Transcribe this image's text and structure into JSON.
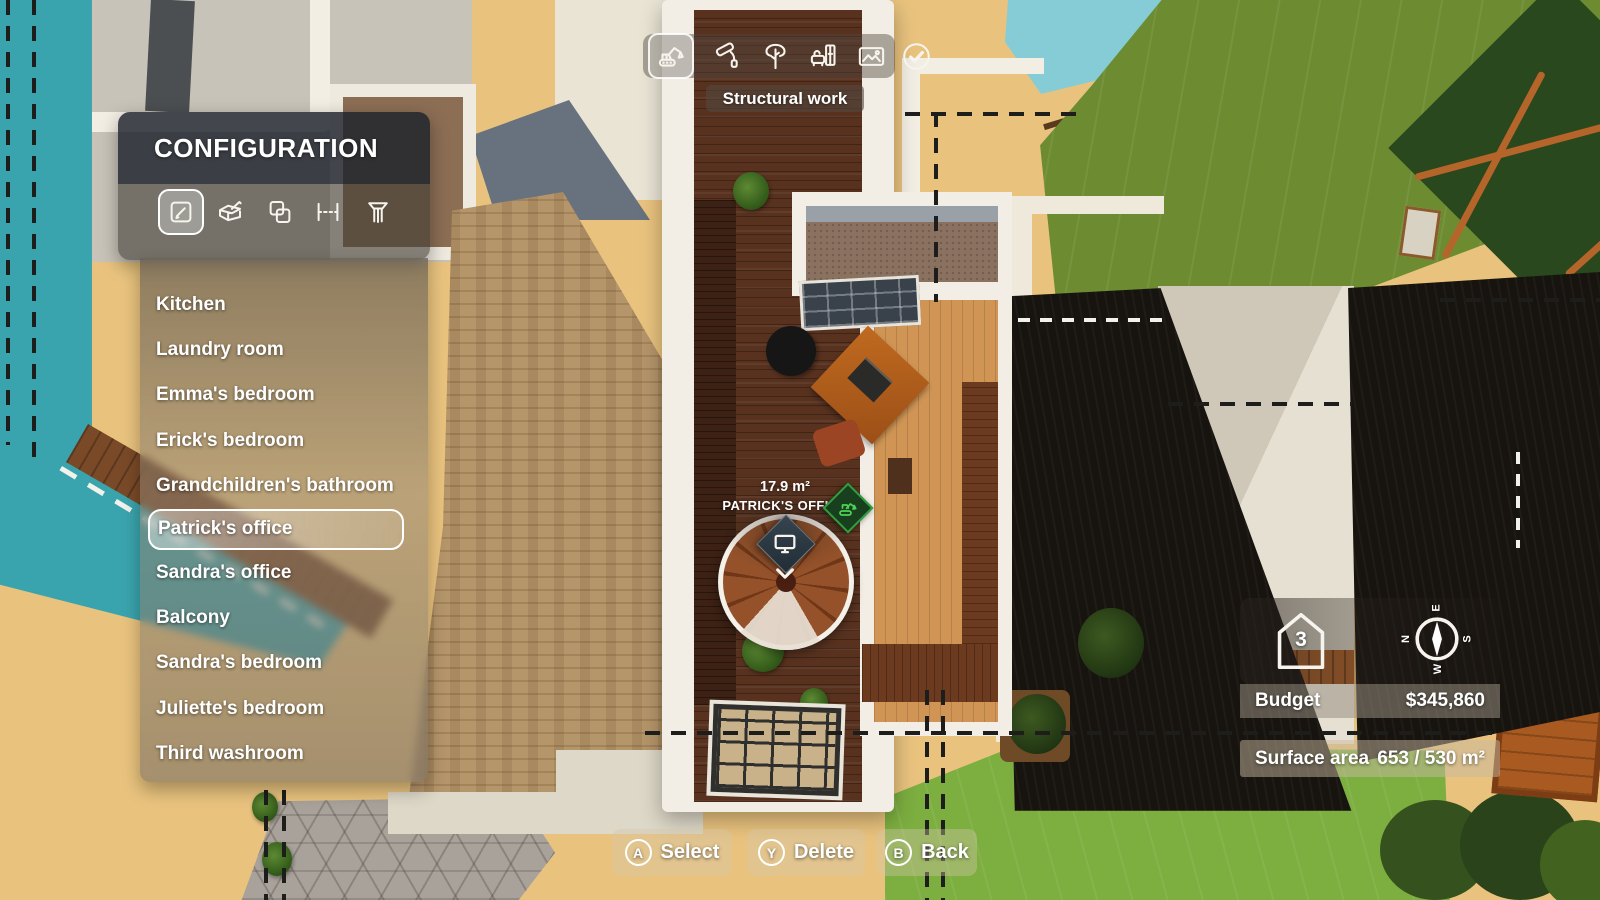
{
  "toolbar": {
    "active_label": "Structural work",
    "items": [
      {
        "name": "structural-work",
        "icon": "excavator-icon",
        "selected": true
      },
      {
        "name": "painting",
        "icon": "paint-roller-icon",
        "selected": false
      },
      {
        "name": "vegetation",
        "icon": "tree-icon",
        "selected": false
      },
      {
        "name": "furnishing",
        "icon": "furniture-icon",
        "selected": false
      },
      {
        "name": "terrain",
        "icon": "terrain-icon",
        "selected": false
      },
      {
        "name": "validate",
        "icon": "check-icon",
        "selected": false
      }
    ]
  },
  "config_panel": {
    "title": "CONFIGURATION",
    "tools": [
      "edit-room",
      "construct-box",
      "duplicate-room",
      "measure-wall",
      "pillar"
    ],
    "selected_tool": "edit-room",
    "rooms": [
      "Kitchen",
      "Laundry room",
      "Emma's bedroom",
      "Erick's bedroom",
      "Grandchildren's bathroom",
      "Patrick's office",
      "Sandra's office",
      "Balcony",
      "Sandra's bedroom",
      "Juliette's bedroom",
      "Third washroom"
    ],
    "selected_room": "Patrick's office"
  },
  "room_marker": {
    "area": "17.9 m²",
    "name": "PATRICK'S OFFICE",
    "badge": "construction-in-progress"
  },
  "hud": {
    "floor_level": "3",
    "compass": {
      "top": "E",
      "right": "S",
      "bottom": "W",
      "left": "N"
    },
    "budget_label": "Budget",
    "budget_value": "$345,860",
    "surface_label": "Surface area",
    "surface_value": "653 / 530 m²"
  },
  "controls": [
    {
      "button": "A",
      "label": "Select"
    },
    {
      "button": "Y",
      "label": "Delete"
    },
    {
      "button": "B",
      "label": "Back"
    }
  ],
  "colors": {
    "water_teal": "#3aa4ae",
    "water_light": "#86ccd6",
    "grass_olive": "#6d8c31",
    "lawn_green": "#7cae40",
    "sand": "#e9c37e",
    "roof_black": "#17130f",
    "corridor_wood": "#58321f",
    "office_wood": "#d09555",
    "marker_navy": "#2c3a44",
    "badge_green": "#2f9e3e",
    "panel_header": "rgba(28,34,44,0.82)"
  }
}
